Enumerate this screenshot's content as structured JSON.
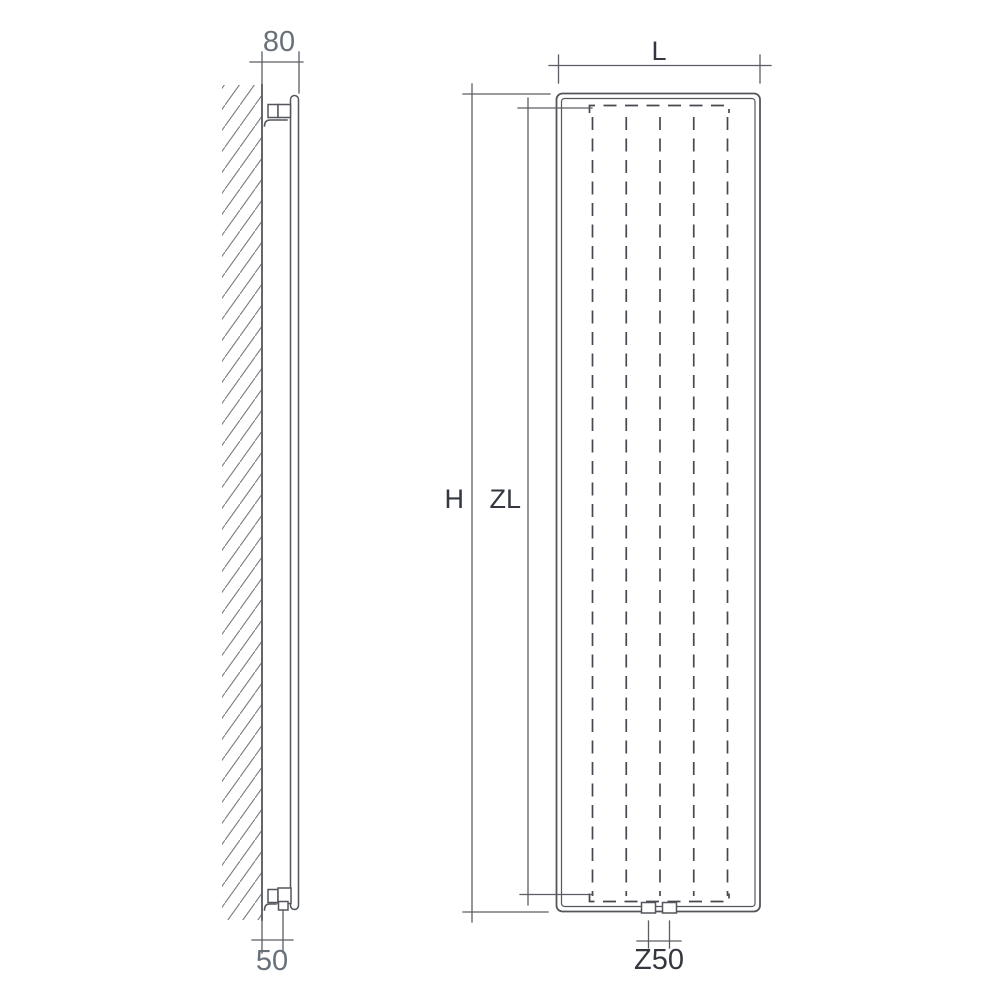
{
  "diagram": {
    "title": "Vertical radiator technical dimension drawing",
    "views": {
      "side_view": {
        "name": "side view (wall mounted)",
        "dimensions": {
          "wall_to_front": "80",
          "wall_to_connection": "50"
        }
      },
      "front_view": {
        "name": "front view",
        "dimensions": {
          "width": "L",
          "height": "H",
          "convector_length": "ZL",
          "connection_spacing": "Z50"
        },
        "fin_lines": 5,
        "connection_nozzles": 2
      }
    },
    "colors": {
      "background": "#ffffff",
      "line": "#53565b",
      "dashed_line": "#46494f",
      "hatch": "#7a7d83",
      "label_gray": "#68717a",
      "label_dark": "#34373f"
    }
  }
}
